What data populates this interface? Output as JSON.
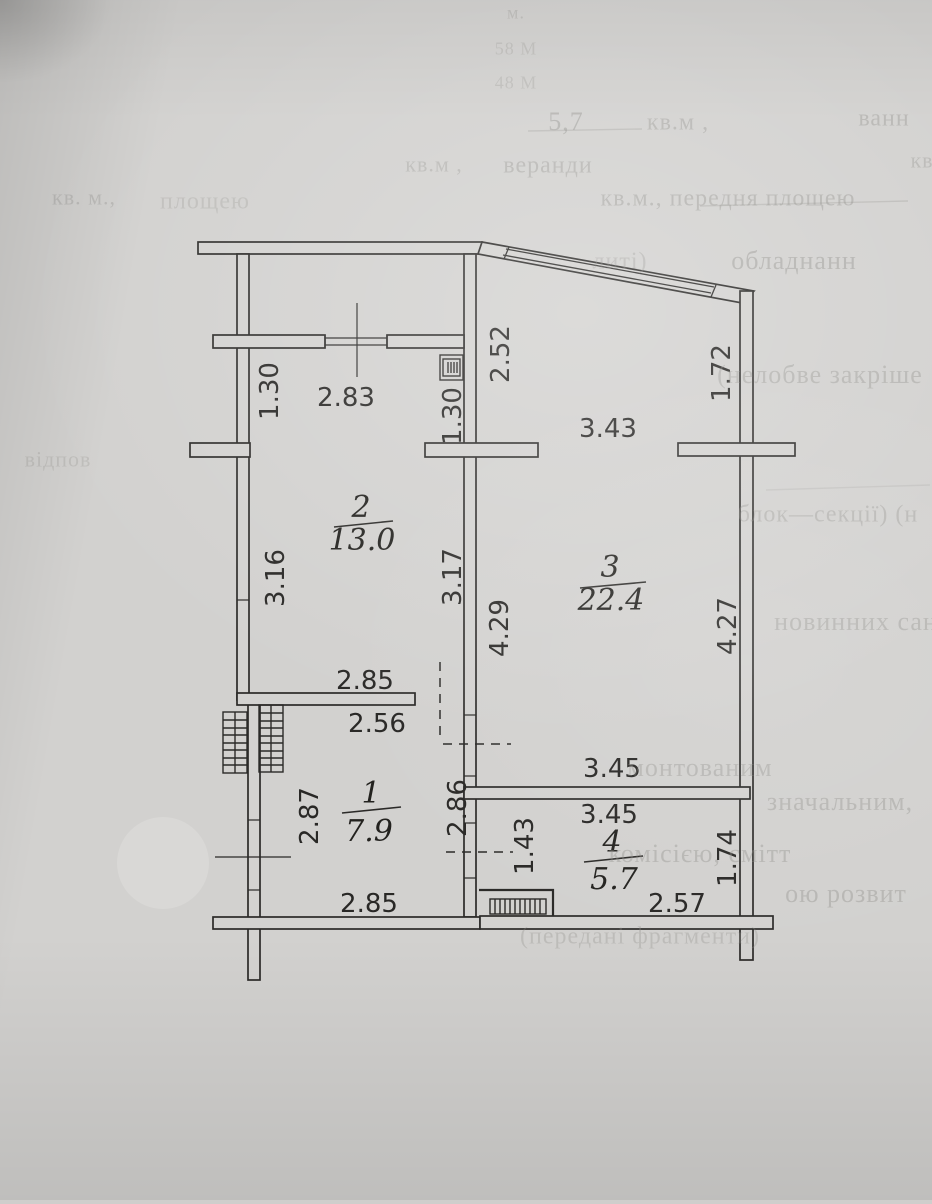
{
  "page": {
    "colors": {
      "paper": "#d2d1cf",
      "ink": "#2b2a28",
      "faint_ink": "#8f8e8a",
      "sticker": "#d9d8d6"
    }
  },
  "floor_plan": {
    "rooms": [
      {
        "number": "2",
        "area": "13.0",
        "num_x": 361,
        "num_y": 517,
        "area_x": 362,
        "area_y": 550,
        "line": [
          334,
          527,
          393,
          521
        ]
      },
      {
        "number": "3",
        "area": "22.4",
        "num_x": 610,
        "num_y": 577,
        "area_x": 611,
        "area_y": 610,
        "line": [
          580,
          588,
          646,
          582
        ]
      },
      {
        "number": "1",
        "area": "7.9",
        "num_x": 371,
        "num_y": 803,
        "area_x": 369,
        "area_y": 841,
        "line": [
          342,
          813,
          401,
          807
        ]
      },
      {
        "number": "4",
        "area": "5.7",
        "num_x": 612,
        "num_y": 852,
        "area_x": 614,
        "area_y": 889,
        "line": [
          584,
          862,
          643,
          856
        ]
      }
    ],
    "dimension_labels": [
      {
        "t": "2.83",
        "x": 346,
        "y": 397,
        "r": 0
      },
      {
        "t": "3.43",
        "x": 608,
        "y": 428,
        "r": 0
      },
      {
        "t": "2.85",
        "x": 365,
        "y": 680,
        "r": 0
      },
      {
        "t": "2.56",
        "x": 377,
        "y": 723,
        "r": 0
      },
      {
        "t": "3.45",
        "x": 612,
        "y": 768,
        "r": 0
      },
      {
        "t": "3.45",
        "x": 609,
        "y": 814,
        "r": 0
      },
      {
        "t": "2.57",
        "x": 677,
        "y": 903,
        "r": 0
      },
      {
        "t": "2.85",
        "x": 369,
        "y": 903,
        "r": 0
      },
      {
        "t": "1.30",
        "x": 269,
        "y": 391,
        "r": -90
      },
      {
        "t": "1.30",
        "x": 452,
        "y": 416,
        "r": -90
      },
      {
        "t": "2.52",
        "x": 500,
        "y": 354,
        "r": -90
      },
      {
        "t": "1.72",
        "x": 721,
        "y": 373,
        "r": -90
      },
      {
        "t": "3.16",
        "x": 275,
        "y": 578,
        "r": -90
      },
      {
        "t": "3.17",
        "x": 452,
        "y": 577,
        "r": -90
      },
      {
        "t": "4.29",
        "x": 499,
        "y": 628,
        "r": -90
      },
      {
        "t": "4.27",
        "x": 727,
        "y": 626,
        "r": -90
      },
      {
        "t": "2.87",
        "x": 309,
        "y": 816,
        "r": -90
      },
      {
        "t": "2.86",
        "x": 457,
        "y": 808,
        "r": -90
      },
      {
        "t": "1.43",
        "x": 524,
        "y": 846,
        "r": -90
      },
      {
        "t": "1.74",
        "x": 727,
        "y": 858,
        "r": -90
      }
    ]
  },
  "faint_text": {
    "fragments": [
      {
        "t": "м.",
        "x": 516,
        "y": 12,
        "s": 18,
        "o": 0.3
      },
      {
        "t": "58 М",
        "x": 516,
        "y": 48,
        "s": 18,
        "o": 0.28
      },
      {
        "t": "48 М",
        "x": 516,
        "y": 82,
        "s": 18,
        "o": 0.28
      },
      {
        "t": "5,7",
        "x": 566,
        "y": 121,
        "s": 26,
        "o": 0.45
      },
      {
        "t": "кв.м ,",
        "x": 678,
        "y": 121,
        "s": 24,
        "o": 0.4
      },
      {
        "t": "ванн",
        "x": 884,
        "y": 117,
        "s": 24,
        "o": 0.4
      },
      {
        "t": "кв.м ,",
        "x": 434,
        "y": 164,
        "s": 22,
        "o": 0.35
      },
      {
        "t": "веранди",
        "x": 548,
        "y": 164,
        "s": 24,
        "o": 0.4
      },
      {
        "t": "кв",
        "x": 922,
        "y": 160,
        "s": 22,
        "o": 0.35
      },
      {
        "t": "кв. м.,",
        "x": 84,
        "y": 197,
        "s": 22,
        "o": 0.33
      },
      {
        "t": "площею",
        "x": 205,
        "y": 200,
        "s": 24,
        "o": 0.26
      },
      {
        "t": "кв.м., передня площею",
        "x": 728,
        "y": 197,
        "s": 24,
        "o": 0.42
      },
      {
        "t": "литі)",
        "x": 620,
        "y": 260,
        "s": 24,
        "o": 0.33
      },
      {
        "t": "обладнанн",
        "x": 794,
        "y": 260,
        "s": 26,
        "o": 0.45
      },
      {
        "t": "(нелобве закріше",
        "x": 820,
        "y": 374,
        "s": 26,
        "o": 0.4
      },
      {
        "t": "відпов",
        "x": 58,
        "y": 459,
        "s": 22,
        "o": 0.26
      },
      {
        "t": "блок—секції)  (н",
        "x": 828,
        "y": 513,
        "s": 24,
        "o": 0.36
      },
      {
        "t": "новинних сан",
        "x": 856,
        "y": 621,
        "s": 26,
        "o": 0.38
      },
      {
        "t": "монтованим",
        "x": 700,
        "y": 767,
        "s": 26,
        "o": 0.36
      },
      {
        "t": "значальним,",
        "x": 840,
        "y": 801,
        "s": 26,
        "o": 0.38
      },
      {
        "t": "комісією,  смітт",
        "x": 700,
        "y": 853,
        "s": 26,
        "o": 0.38
      },
      {
        "t": "ою розвит",
        "x": 846,
        "y": 893,
        "s": 26,
        "o": 0.38
      },
      {
        "t": "(передані фрагменти)",
        "x": 640,
        "y": 935,
        "s": 24,
        "o": 0.3
      }
    ]
  }
}
